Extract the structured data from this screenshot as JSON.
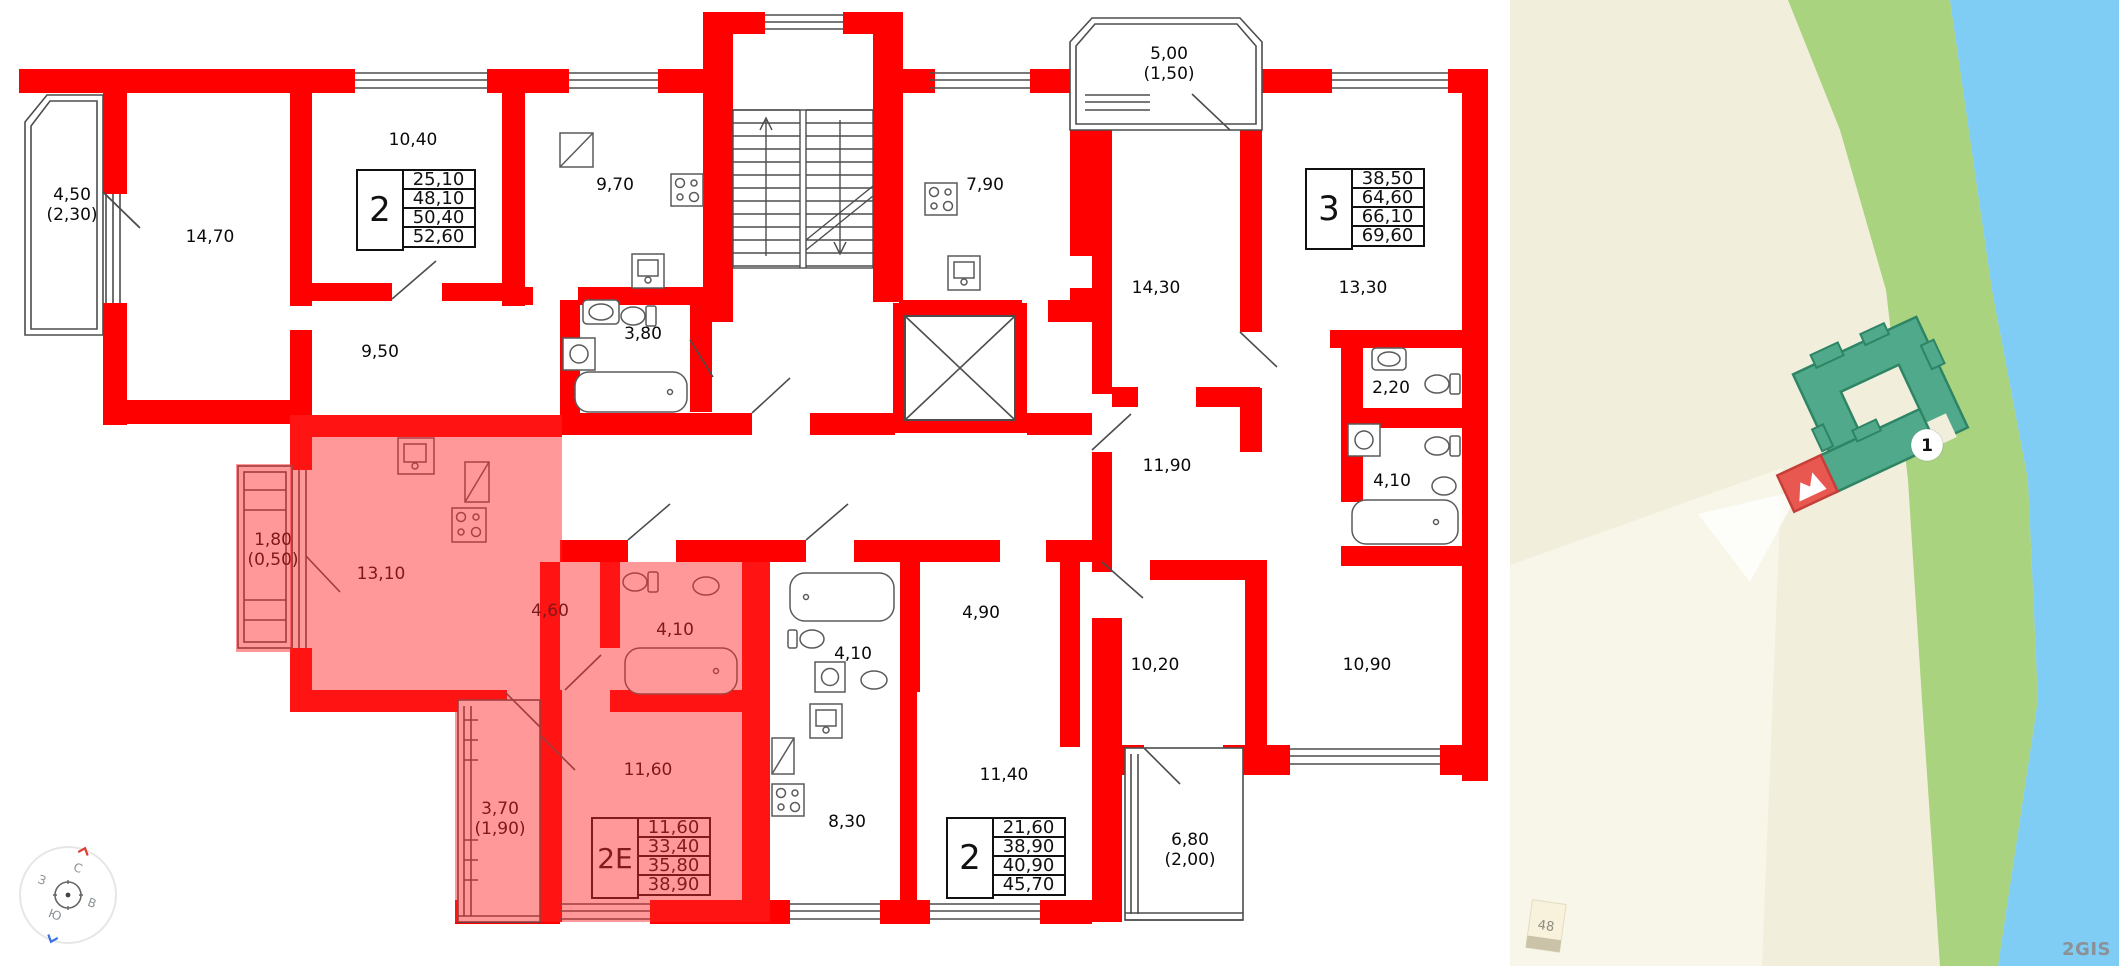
{
  "floorplan": {
    "rooms": [
      {
        "name": "balcony-4-50",
        "label": "4,50",
        "sub": "(2,30)",
        "x": 72,
        "y": 205,
        "highlighted": false
      },
      {
        "name": "room-14-70",
        "label": "14,70",
        "x": 210,
        "y": 237,
        "highlighted": false
      },
      {
        "name": "room-10-40",
        "label": "10,40",
        "x": 413,
        "y": 140,
        "highlighted": false
      },
      {
        "name": "kitchen-9-70",
        "label": "9,70",
        "x": 615,
        "y": 185,
        "highlighted": false
      },
      {
        "name": "kitchen-7-90",
        "label": "7,90",
        "x": 985,
        "y": 185,
        "highlighted": false
      },
      {
        "name": "balcony-5-00",
        "label": "5,00",
        "sub": "(1,50)",
        "x": 1169,
        "y": 64,
        "highlighted": false
      },
      {
        "name": "room-14-30",
        "label": "14,30",
        "x": 1156,
        "y": 288,
        "highlighted": false
      },
      {
        "name": "room-13-30",
        "label": "13,30",
        "x": 1363,
        "y": 288,
        "highlighted": false
      },
      {
        "name": "corridor-9-50",
        "label": "9,50",
        "x": 380,
        "y": 352,
        "highlighted": false
      },
      {
        "name": "bath-3-80",
        "label": "3,80",
        "x": 643,
        "y": 334,
        "highlighted": false
      },
      {
        "name": "bath-2-20",
        "label": "2,20",
        "x": 1391,
        "y": 388,
        "highlighted": false
      },
      {
        "name": "bath-4-10-right",
        "label": "4,10",
        "x": 1392,
        "y": 481,
        "highlighted": false
      },
      {
        "name": "room-11-90",
        "label": "11,90",
        "x": 1167,
        "y": 466,
        "highlighted": false
      },
      {
        "name": "balcony-1-80",
        "label": "1,80",
        "sub": "(0,50)",
        "x": 273,
        "y": 550,
        "highlighted": true
      },
      {
        "name": "kitchen-13-10",
        "label": "13,10",
        "x": 381,
        "y": 574,
        "highlighted": true
      },
      {
        "name": "hall-4-60",
        "label": "4,60",
        "x": 550,
        "y": 611,
        "highlighted": true
      },
      {
        "name": "bath-4-10-selected",
        "label": "4,10",
        "x": 675,
        "y": 630,
        "highlighted": true
      },
      {
        "name": "room-11-60",
        "label": "11,60",
        "x": 648,
        "y": 770,
        "highlighted": true
      },
      {
        "name": "balcony-3-70",
        "label": "3,70",
        "sub": "(1,90)",
        "x": 500,
        "y": 819,
        "highlighted": true
      },
      {
        "name": "bath-4-10-mid",
        "label": "4,10",
        "x": 853,
        "y": 654,
        "highlighted": false
      },
      {
        "name": "hall-4-90",
        "label": "4,90",
        "x": 981,
        "y": 613,
        "highlighted": false
      },
      {
        "name": "kitchen-8-30",
        "label": "8,30",
        "x": 847,
        "y": 822,
        "highlighted": false
      },
      {
        "name": "room-11-40",
        "label": "11,40",
        "x": 1004,
        "y": 775,
        "highlighted": false
      },
      {
        "name": "room-10-20",
        "label": "10,20",
        "x": 1155,
        "y": 665,
        "highlighted": false
      },
      {
        "name": "room-10-90",
        "label": "10,90",
        "x": 1367,
        "y": 665,
        "highlighted": false
      },
      {
        "name": "balcony-6-80",
        "label": "6,80",
        "sub": "(2,00)",
        "x": 1190,
        "y": 850,
        "highlighted": false
      }
    ],
    "apartment_tables": [
      {
        "name": "apartment-2-top",
        "type": "2",
        "values": [
          "25,10",
          "48,10",
          "50,40",
          "52,60"
        ],
        "x": 356,
        "y": 169,
        "highlighted": false
      },
      {
        "name": "apartment-3",
        "type": "3",
        "values": [
          "38,50",
          "64,60",
          "66,10",
          "69,60"
        ],
        "x": 1305,
        "y": 168,
        "highlighted": false
      },
      {
        "name": "apartment-2e-selected",
        "type": "2Е",
        "values": [
          "11,60",
          "33,40",
          "35,80",
          "38,90"
        ],
        "x": 591,
        "y": 817,
        "highlighted": true
      },
      {
        "name": "apartment-2-bottom",
        "type": "2",
        "values": [
          "21,60",
          "38,90",
          "40,90",
          "45,70"
        ],
        "x": 946,
        "y": 817,
        "highlighted": false
      }
    ],
    "colors": {
      "wall": "#FF0000",
      "highlight": "rgba(255,40,40,0.48)",
      "line": "#4d4d4d",
      "text": "#0a0a0a"
    }
  },
  "map": {
    "marker_label": "1",
    "house_label": "48",
    "watermark": "2GIS",
    "colors": {
      "land": "#F2EEDC",
      "road": "#F8F5E9",
      "green": "#A9D37E",
      "water": "#7FCDF4",
      "building": "#4FA98A",
      "building_stroke": "#2E8565",
      "selected": "#E95850",
      "selected_stroke": "#C53F38"
    }
  },
  "compass": {
    "north": "С",
    "east": "В",
    "south": "Ю",
    "west": "З"
  }
}
